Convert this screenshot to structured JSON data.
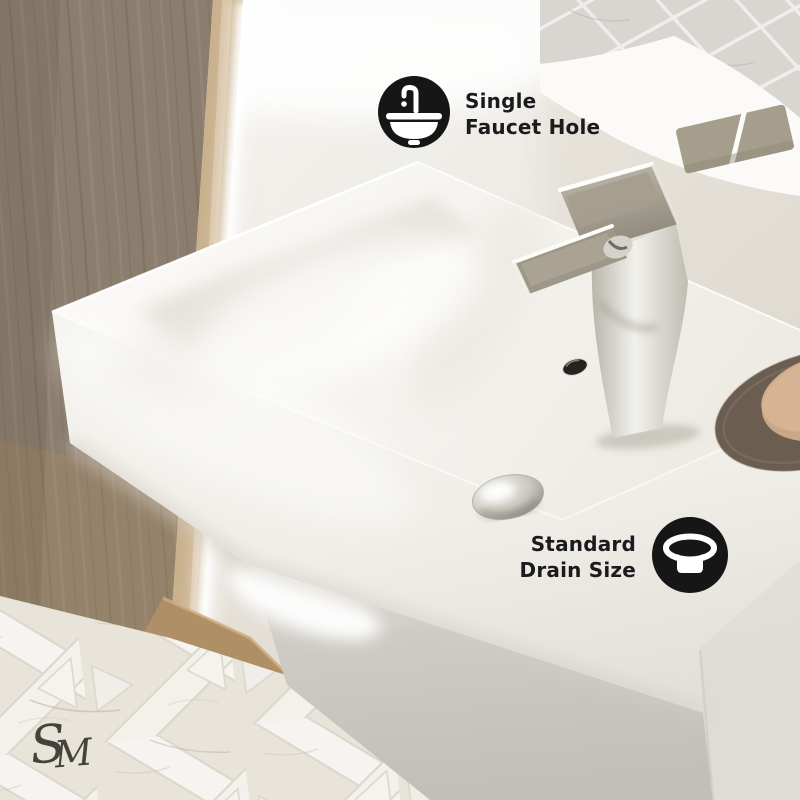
{
  "annotations": {
    "faucet_hole_badge": {
      "line1": "Single",
      "line2": "Faucet Hole",
      "icon": "single-faucet-hole-icon"
    },
    "drain_size_badge": {
      "line1": "Standard",
      "line2": "Drain Size",
      "icon": "standard-drain-icon"
    }
  },
  "watermark": {
    "letter_s": "S",
    "letter_m": "M"
  },
  "colors": {
    "badge_icon_bg": "#161616",
    "badge_icon_glyph": "#ffffff",
    "badge_text": "#1b1b1d",
    "sink_white": "#f6f5f1",
    "wood_panel": "#8c7e6e",
    "wood_edge": "#c9b18d",
    "wood_plinth": "#ae8f66",
    "chrome_fixture": "#d6d3cc",
    "soap_tray": "#6c5d51",
    "soap_bar": "#c9a787",
    "wall": "#e7e3db",
    "tile_floor": "#efece5",
    "mirror_tiles": "#d9d6d1",
    "flush_plate": "#a69e8d",
    "watermark_color": "#45423d"
  }
}
